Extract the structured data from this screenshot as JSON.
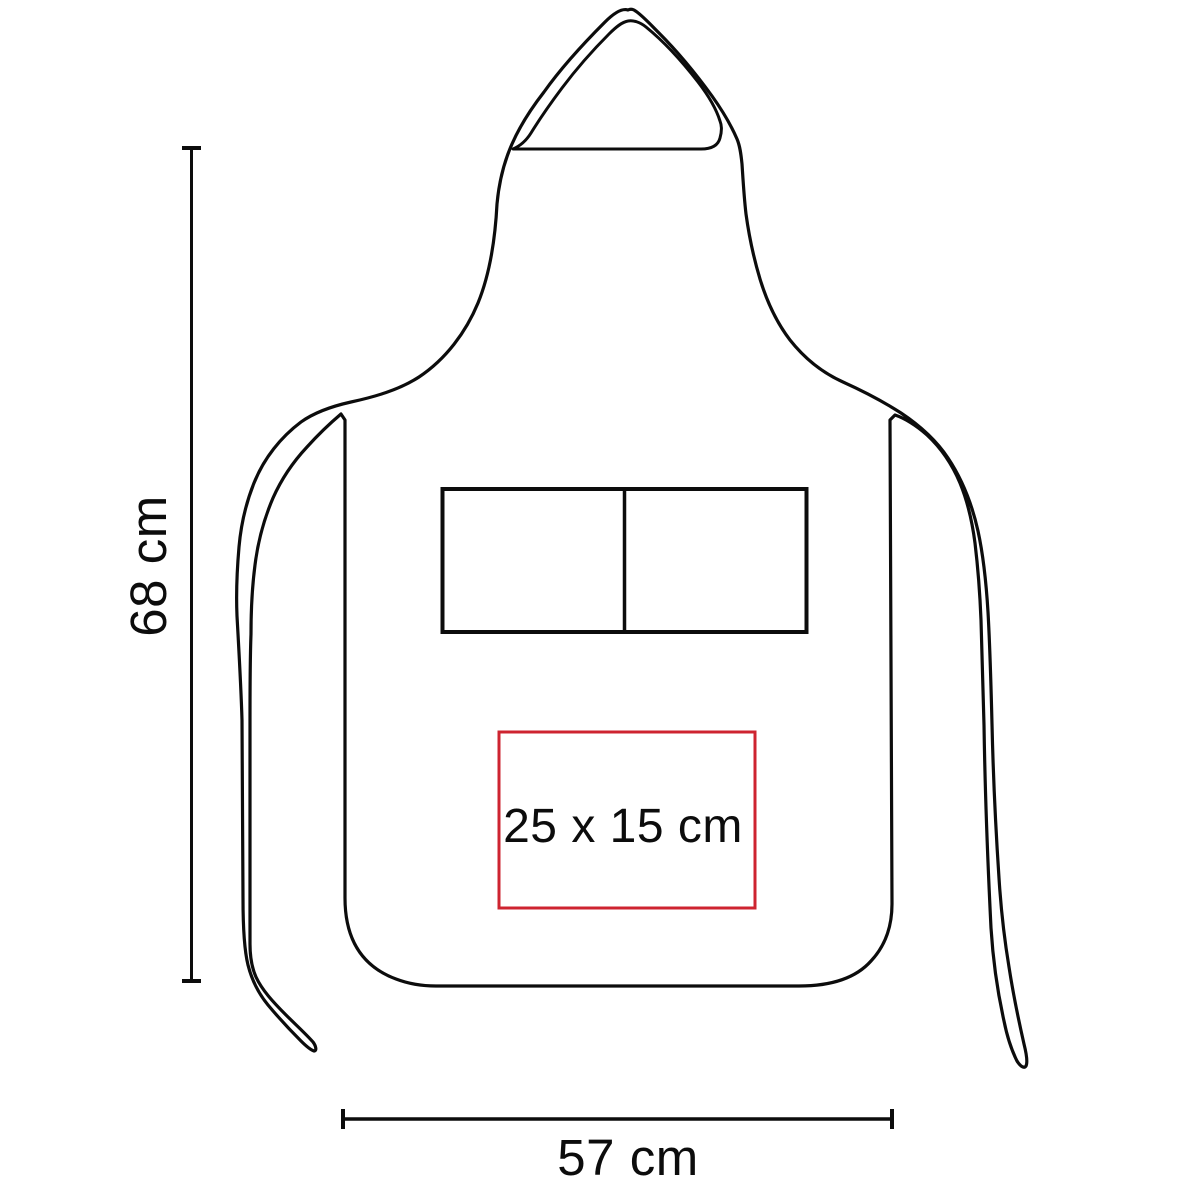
{
  "labels": {
    "height": "68 cm",
    "width": "57 cm",
    "print_area": "25 x 15 cm"
  },
  "values": {
    "height_cm": 68,
    "width_cm": 57,
    "print_area_width_cm": 25,
    "print_area_height_cm": 15
  },
  "colors": {
    "background": "#ffffff",
    "line": "#0c0c0c",
    "print_area_border": "#ce2430"
  }
}
